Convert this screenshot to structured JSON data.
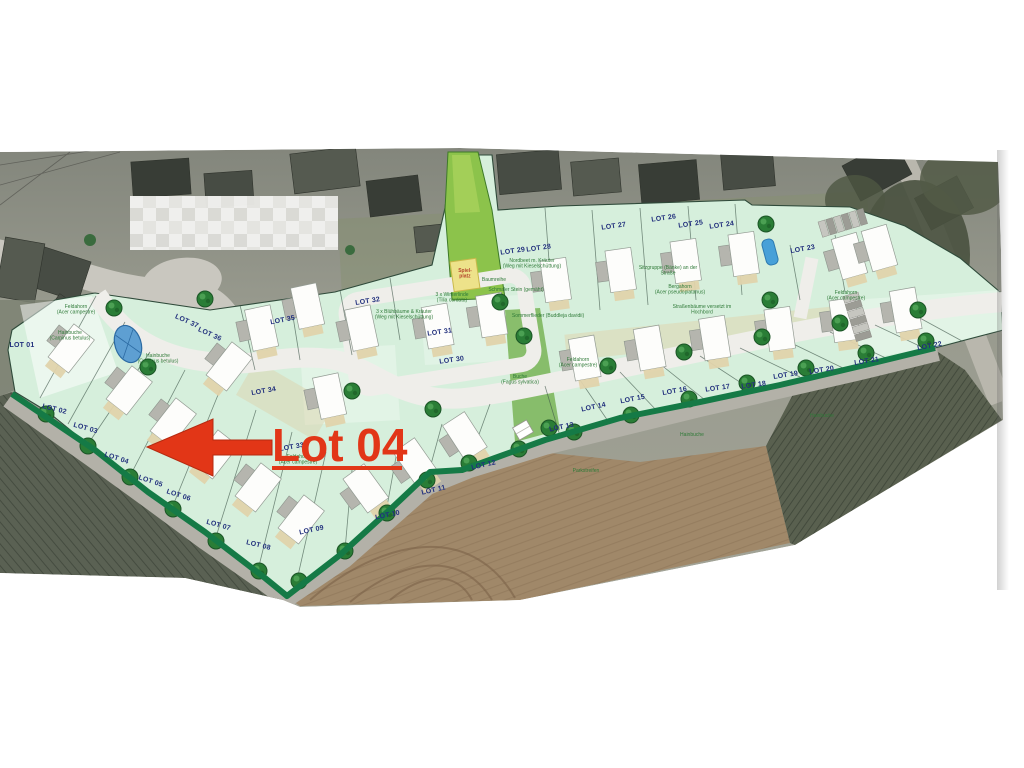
{
  "callout": {
    "label": "Lot 04",
    "color": "#e23617",
    "underlined": true,
    "arrow_direction": "left"
  },
  "colors": {
    "page_background": "#ffffff",
    "plan_green": "#d6efdc",
    "corridor_green": "#8cc34b",
    "perimeter_band_green": "#157a46",
    "road_gray": "#efeeea",
    "field_brown": "#a08869",
    "field_dark": "#59604f",
    "lot_label_navy": "#22307d",
    "annotation_green": "#2f7a38",
    "pond_blue": "#5e9fd2"
  },
  "plan": {
    "lots": [
      {
        "label": "LOT 01",
        "x": 22,
        "y": 347,
        "rot": 0
      },
      {
        "label": "LOT 02",
        "x": 54,
        "y": 411,
        "rot": 14
      },
      {
        "label": "LOT 03",
        "x": 85,
        "y": 430,
        "rot": 16
      },
      {
        "label": "LOT 04",
        "x": 116,
        "y": 460,
        "rot": 18
      },
      {
        "label": "LOT 05",
        "x": 150,
        "y": 483,
        "rot": 18
      },
      {
        "label": "LOT 06",
        "x": 178,
        "y": 497,
        "rot": 18
      },
      {
        "label": "LOT 07",
        "x": 218,
        "y": 527,
        "rot": 16
      },
      {
        "label": "LOT 08",
        "x": 258,
        "y": 547,
        "rot": 14
      },
      {
        "label": "LOT 09",
        "x": 312,
        "y": 532,
        "rot": -12
      },
      {
        "label": "LOT 10",
        "x": 388,
        "y": 517,
        "rot": -12
      },
      {
        "label": "LOT 11",
        "x": 434,
        "y": 492,
        "rot": -13
      },
      {
        "label": "LOT 12",
        "x": 484,
        "y": 467,
        "rot": -13
      },
      {
        "label": "LOT 13",
        "x": 562,
        "y": 429,
        "rot": -12
      },
      {
        "label": "LOT 14",
        "x": 594,
        "y": 409,
        "rot": -12
      },
      {
        "label": "LOT 15",
        "x": 633,
        "y": 401,
        "rot": -11
      },
      {
        "label": "LOT 16",
        "x": 675,
        "y": 393,
        "rot": -10
      },
      {
        "label": "LOT 17",
        "x": 718,
        "y": 390,
        "rot": -8
      },
      {
        "label": "LOT 18",
        "x": 754,
        "y": 387,
        "rot": -8
      },
      {
        "label": "LOT 19",
        "x": 786,
        "y": 377,
        "rot": -9
      },
      {
        "label": "LOT 20",
        "x": 822,
        "y": 372,
        "rot": -9
      },
      {
        "label": "LOT 21",
        "x": 867,
        "y": 363,
        "rot": -9
      },
      {
        "label": "LOT 22",
        "x": 930,
        "y": 348,
        "rot": -11
      },
      {
        "label": "LOT 23",
        "x": 803,
        "y": 251,
        "rot": -10
      },
      {
        "label": "LOT 24",
        "x": 722,
        "y": 227,
        "rot": -8
      },
      {
        "label": "LOT 25",
        "x": 691,
        "y": 226,
        "rot": -8
      },
      {
        "label": "LOT 26",
        "x": 664,
        "y": 220,
        "rot": -8
      },
      {
        "label": "LOT 27",
        "x": 614,
        "y": 228,
        "rot": -8
      },
      {
        "label": "LOT 28",
        "x": 539,
        "y": 250,
        "rot": -8
      },
      {
        "label": "LOT 29",
        "x": 513,
        "y": 253,
        "rot": -8
      },
      {
        "label": "LOT 30",
        "x": 452,
        "y": 362,
        "rot": -8
      },
      {
        "label": "LOT 31",
        "x": 440,
        "y": 334,
        "rot": -8
      },
      {
        "label": "LOT 32",
        "x": 368,
        "y": 303,
        "rot": -9
      },
      {
        "label": "LOT 33",
        "x": 292,
        "y": 449,
        "rot": -10
      },
      {
        "label": "LOT 34",
        "x": 264,
        "y": 393,
        "rot": -10
      },
      {
        "label": "LOT 35",
        "x": 283,
        "y": 322,
        "rot": -11
      },
      {
        "label": "LOT 36",
        "x": 209,
        "y": 336,
        "rot": 24
      },
      {
        "label": "LOT 37",
        "x": 186,
        "y": 323,
        "rot": 24
      }
    ],
    "annotations": [
      {
        "text": "Feldahorn",
        "text2": "(Acer campestre)",
        "x": 76,
        "y": 308
      },
      {
        "text": "Hainbuche",
        "text2": "(Carpinus betulus)",
        "x": 70,
        "y": 334
      },
      {
        "text": "Hainbuche",
        "text2": "(Carpinus betulus)",
        "x": 158,
        "y": 357
      },
      {
        "text": "Nordbeet m. Kräuter",
        "text2": "(Weg mit Kieselschüttung)",
        "x": 532,
        "y": 262
      },
      {
        "text": "3 x Blühbäume & Kräuter",
        "text2": "(Weg mit Kieselschüttung)",
        "x": 404,
        "y": 313
      },
      {
        "text": "3 x Winterlinde",
        "text2": "(Tilia cordata)",
        "x": 452,
        "y": 296
      },
      {
        "text": "Baumreihe",
        "x": 494,
        "y": 281
      },
      {
        "text": "Schmaler Stein (gemäht)",
        "x": 516,
        "y": 291
      },
      {
        "text": "Sommerflieder (Buddleja davidii)",
        "x": 548,
        "y": 317
      },
      {
        "text": "Sitzgruppe (Bänke) an der",
        "text2": "Straße",
        "x": 668,
        "y": 269
      },
      {
        "text": "Bergahorn",
        "text2": "(Acer pseudoplatanus)",
        "x": 680,
        "y": 288
      },
      {
        "text": "Straßenbäume versetzt im",
        "text2": "Hochbord",
        "x": 702,
        "y": 308
      },
      {
        "text": "Feldahorn",
        "text2": "(Acer campestre)",
        "x": 846,
        "y": 294
      },
      {
        "text": "Feldahorn",
        "text2": "(Acer campestre)",
        "x": 578,
        "y": 361
      },
      {
        "text": "Buche",
        "text2": "(Fagus sylvatica)",
        "x": 520,
        "y": 378
      },
      {
        "text": "Feldahorn",
        "text2": "(Acer campestre)",
        "x": 298,
        "y": 458
      },
      {
        "text": "Hainbuche",
        "x": 692,
        "y": 436
      },
      {
        "text": "Hainbuche",
        "x": 822,
        "y": 417
      },
      {
        "text": "Parkstreifen",
        "x": 586,
        "y": 472
      },
      {
        "text": "Spiel-",
        "text2": "platz",
        "x": 465,
        "y": 272,
        "cls": "red"
      }
    ],
    "houses": [
      {
        "x": 70,
        "y": 350,
        "r": 38
      },
      {
        "x": 128,
        "y": 392,
        "r": 38
      },
      {
        "x": 172,
        "y": 424,
        "r": 38
      },
      {
        "x": 214,
        "y": 456,
        "r": 38
      },
      {
        "x": 257,
        "y": 489,
        "r": 38
      },
      {
        "x": 300,
        "y": 521,
        "r": 38
      },
      {
        "x": 367,
        "y": 490,
        "r": -36
      },
      {
        "x": 417,
        "y": 464,
        "r": -35
      },
      {
        "x": 466,
        "y": 438,
        "r": -33
      },
      {
        "x": 585,
        "y": 360,
        "r": -10
      },
      {
        "x": 650,
        "y": 350,
        "r": -10
      },
      {
        "x": 715,
        "y": 340,
        "r": -9
      },
      {
        "x": 780,
        "y": 331,
        "r": -8
      },
      {
        "x": 845,
        "y": 322,
        "r": -8
      },
      {
        "x": 906,
        "y": 312,
        "r": -10
      },
      {
        "x": 556,
        "y": 282,
        "r": -8
      },
      {
        "x": 621,
        "y": 272,
        "r": -8
      },
      {
        "x": 686,
        "y": 263,
        "r": -8
      },
      {
        "x": 744,
        "y": 256,
        "r": -8
      },
      {
        "x": 228,
        "y": 368,
        "r": 38
      },
      {
        "x": 262,
        "y": 330,
        "r": -12
      },
      {
        "x": 308,
        "y": 308,
        "r": -12
      },
      {
        "x": 362,
        "y": 330,
        "r": -12
      },
      {
        "x": 438,
        "y": 328,
        "r": -10
      },
      {
        "x": 492,
        "y": 317,
        "r": -9
      },
      {
        "x": 330,
        "y": 398,
        "r": -12
      },
      {
        "x": 850,
        "y": 258,
        "r": -16
      },
      {
        "x": 880,
        "y": 250,
        "r": -16
      }
    ],
    "trees": [
      {
        "x": 46,
        "y": 414
      },
      {
        "x": 88,
        "y": 446
      },
      {
        "x": 130,
        "y": 477
      },
      {
        "x": 173,
        "y": 509
      },
      {
        "x": 216,
        "y": 541
      },
      {
        "x": 259,
        "y": 571
      },
      {
        "x": 299,
        "y": 581
      },
      {
        "x": 345,
        "y": 551
      },
      {
        "x": 387,
        "y": 513
      },
      {
        "x": 427,
        "y": 480
      },
      {
        "x": 469,
        "y": 463
      },
      {
        "x": 519,
        "y": 449
      },
      {
        "x": 574,
        "y": 432
      },
      {
        "x": 631,
        "y": 415
      },
      {
        "x": 689,
        "y": 399
      },
      {
        "x": 747,
        "y": 383
      },
      {
        "x": 806,
        "y": 368
      },
      {
        "x": 866,
        "y": 353
      },
      {
        "x": 926,
        "y": 341
      },
      {
        "x": 205,
        "y": 299
      },
      {
        "x": 352,
        "y": 391
      },
      {
        "x": 433,
        "y": 409
      },
      {
        "x": 608,
        "y": 366
      },
      {
        "x": 684,
        "y": 352
      },
      {
        "x": 762,
        "y": 337
      },
      {
        "x": 840,
        "y": 323
      },
      {
        "x": 918,
        "y": 310
      },
      {
        "x": 500,
        "y": 302
      },
      {
        "x": 524,
        "y": 336
      },
      {
        "x": 549,
        "y": 428
      },
      {
        "x": 770,
        "y": 300
      },
      {
        "x": 766,
        "y": 224
      },
      {
        "x": 114,
        "y": 308
      },
      {
        "x": 148,
        "y": 367
      }
    ]
  }
}
